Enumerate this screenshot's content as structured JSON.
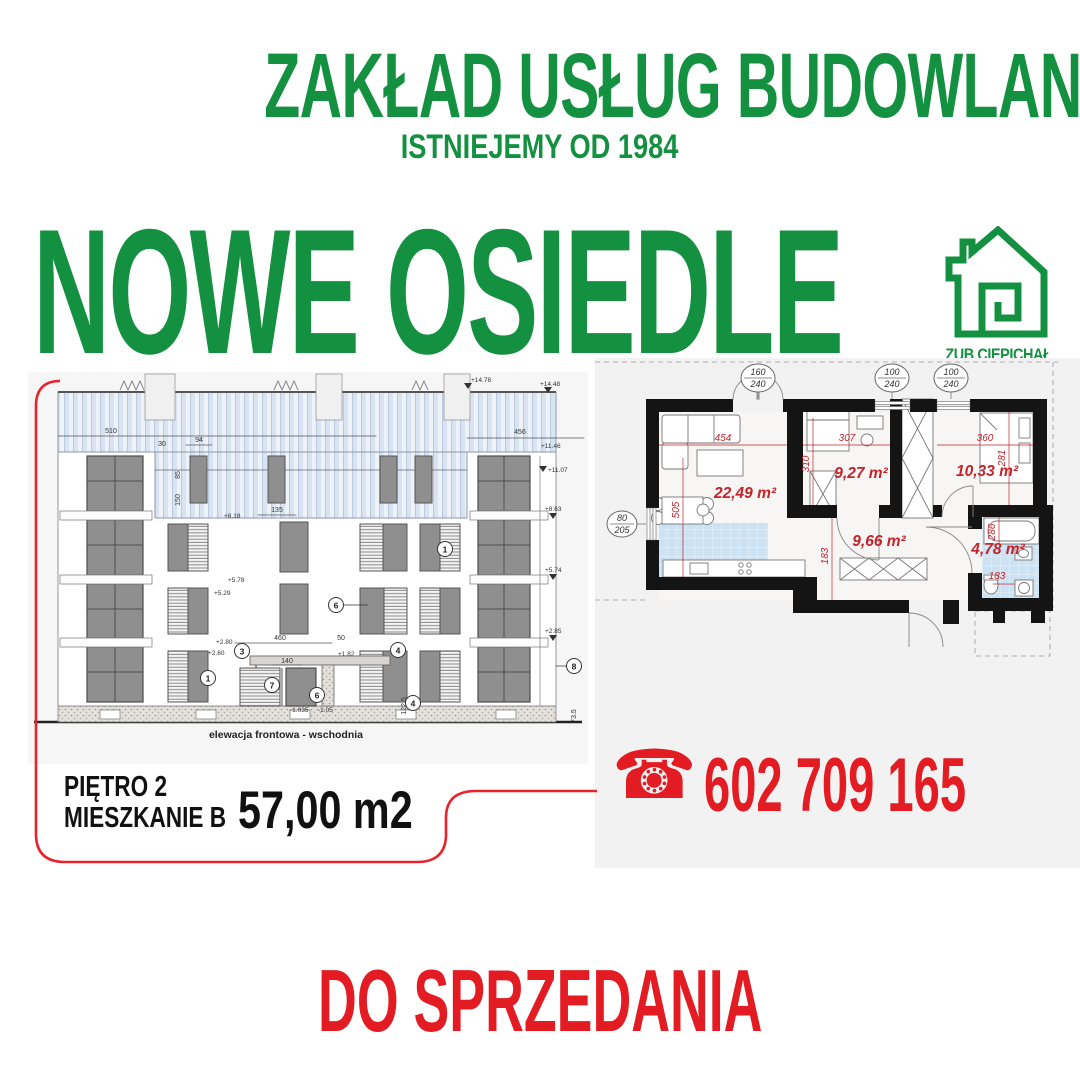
{
  "colors": {
    "brand_green": "#149140",
    "accent_red": "#e31b22",
    "plan_red": "#c4232a",
    "panel_gray": "#f2f2f2",
    "tile_blue": "#cce2f2",
    "wall_black": "#141414"
  },
  "header": {
    "company": "ZAKŁAD USŁUG BUDOWLANYCH",
    "since": "ISTNIEJEMY OD 1984"
  },
  "hero": {
    "title": "NOWE OSIEDLE"
  },
  "logo": {
    "label": "ZUB CIEPICHAŁ",
    "icon": "house-outline-icon"
  },
  "elevation": {
    "caption": "elewacja frontowa - wschodnia",
    "dims": {
      "w510": "510",
      "w30": "30",
      "w94": "94",
      "h85": "85",
      "h150": "150",
      "w456": "456",
      "w135": "135",
      "w460": "460",
      "w50": "50",
      "w140": "140",
      "h1225": "122.5",
      "h735": "73.5"
    },
    "levels": {
      "p1478": "+14.78",
      "p1448": "+14.48",
      "p1146": "+11.46",
      "p1107": "+11.07",
      "p863": "+8.63",
      "p818": "+8.18",
      "p578": "+5.78",
      "p529": "+5.29",
      "p574": "+5.74",
      "p285": "+2.85",
      "p280": "+2.80",
      "p260": "+2.60",
      "p182": "+1.82",
      "m1035": "-1.035",
      "m105": "-1.05"
    },
    "tags": {
      "n1": "1",
      "n3": "3",
      "n4": "4",
      "n6": "6",
      "n7": "7",
      "n8": "8"
    }
  },
  "floorplan": {
    "areas": {
      "living": "22,49 m²",
      "bedroom1": "9,27 m²",
      "bedroom2": "10,33 m²",
      "hall": "9,66 m²",
      "bath": "4,78 m²"
    },
    "dims": {
      "d454": "454",
      "d307": "307",
      "d360": "360",
      "d310": "310",
      "d281": "281",
      "d505": "505",
      "d183a": "183",
      "d286": "286",
      "d183b": "183"
    },
    "tags": {
      "t1a": "160",
      "t1b": "240",
      "t2a": "100",
      "t2b": "240",
      "t3a": "100",
      "t3b": "240",
      "t4a": "80",
      "t4b": "205"
    }
  },
  "listing": {
    "floor": "PIĘTRO 2",
    "unit": "MIESZKANIE B",
    "area": "57,00 m2"
  },
  "contact": {
    "phone": "602 709 165",
    "phone_icon_glyph": "☎"
  },
  "footer": {
    "status": "DO SPRZEDANIA"
  }
}
